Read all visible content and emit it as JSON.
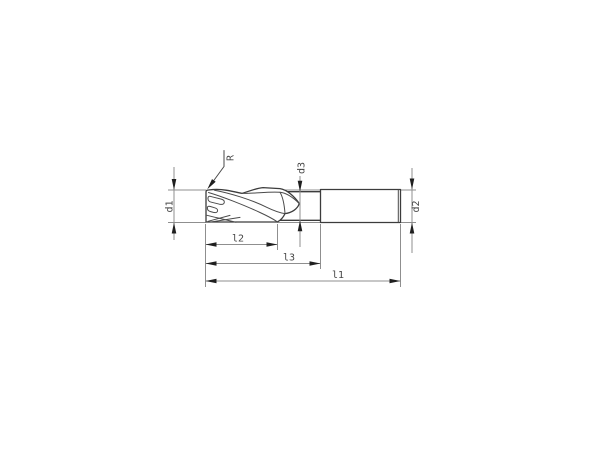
{
  "drawing": {
    "type": "technical-drawing-end-mill",
    "labels": {
      "corner_radius": "R",
      "cutting_diameter": "d1",
      "shank_diameter": "d2",
      "neck_diameter": "d3",
      "overall_length": "l1",
      "flute_length": "l2",
      "reach_length": "l3"
    },
    "colors": {
      "background": "#ffffff",
      "part_outline": "#3c3c3c",
      "dimension_lines": "#8f8f8f",
      "arrowheads": "#1f1f1f",
      "label_text": "#474747"
    }
  }
}
